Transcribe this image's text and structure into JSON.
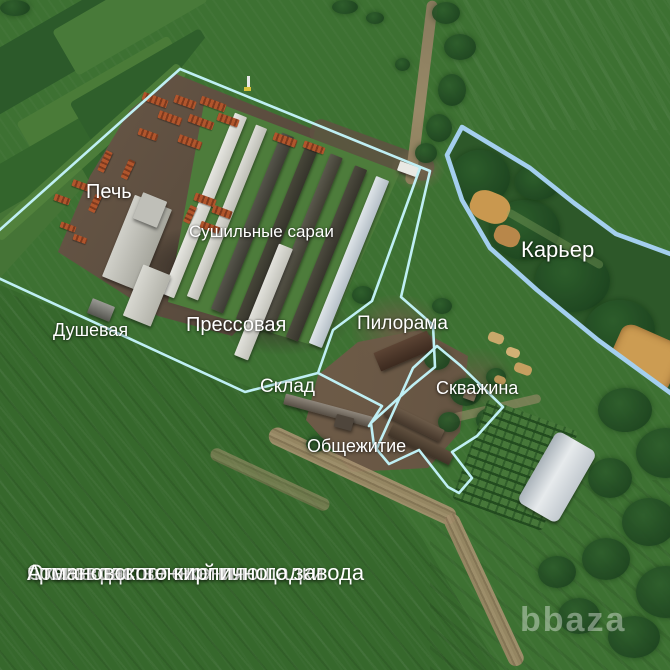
{
  "map": {
    "labels": [
      {
        "id": "pech",
        "text": "Печь"
      },
      {
        "id": "sushilnye-sarai",
        "text": "Сушильные сараи"
      },
      {
        "id": "dushevaya",
        "text": "Душевая"
      },
      {
        "id": "pressovaya",
        "text": "Прессовая"
      },
      {
        "id": "pilorama",
        "text": "Пилорама"
      },
      {
        "id": "sklad",
        "text": "Склад"
      },
      {
        "id": "obshchezhitie",
        "text": "Общежитие"
      },
      {
        "id": "skvazhina",
        "text": "Скважина"
      },
      {
        "id": "karier",
        "text": "Карьер"
      }
    ],
    "caption": {
      "line1": "Схема расположения",
      "line2": "производственной площадки",
      "line3": "Атмановского кирпичного завода"
    },
    "watermark": "bbaza",
    "colors": {
      "site_outline": "#bfeff4",
      "quarry_outline": "#a4cfee",
      "label_text": "#ffffff"
    }
  }
}
